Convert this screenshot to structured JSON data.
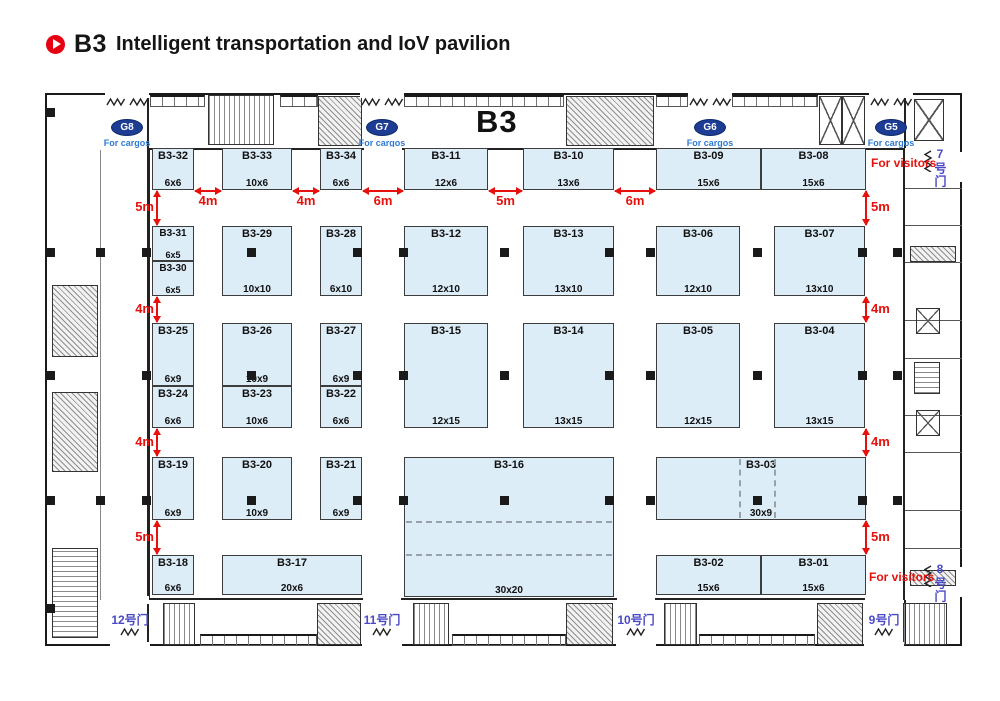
{
  "header": {
    "title_code": "B3",
    "title_text": "Intelligent transportation and IoV pavilion"
  },
  "plan": {
    "hall_label": "B3",
    "gates": [
      {
        "id": "G8",
        "cargo_label": "For cargos",
        "cx": 127
      },
      {
        "id": "G7",
        "cargo_label": "For cargos",
        "cx": 382
      },
      {
        "id": "G6",
        "cargo_label": "For cargos",
        "cx": 710
      },
      {
        "id": "G5",
        "cargo_label": "For cargos",
        "cx": 891
      }
    ],
    "visitor_labels": [
      {
        "text": "For visitors",
        "x": 871,
        "y": 156
      },
      {
        "text": "For visitors",
        "x": 869,
        "y": 570
      }
    ],
    "side_doors": [
      {
        "label": "7号门",
        "x": 934,
        "y": 147
      },
      {
        "label": "8号门",
        "x": 934,
        "y": 562
      }
    ],
    "bottom_doors": [
      {
        "label": "12号门",
        "cx": 130
      },
      {
        "label": "11号门",
        "cx": 382
      },
      {
        "label": "10号门",
        "cx": 636
      },
      {
        "label": "9号门",
        "cx": 884
      }
    ],
    "booths": [
      {
        "id": "B3-32",
        "size": "6x6",
        "x": 152,
        "y": 148,
        "w": 42,
        "h": 42
      },
      {
        "id": "B3-33",
        "size": "10x6",
        "x": 222,
        "y": 148,
        "w": 70,
        "h": 42
      },
      {
        "id": "B3-34",
        "size": "6x6",
        "x": 320,
        "y": 148,
        "w": 42,
        "h": 42
      },
      {
        "id": "B3-11",
        "size": "12x6",
        "x": 404,
        "y": 148,
        "w": 84,
        "h": 42
      },
      {
        "id": "B3-10",
        "size": "13x6",
        "x": 523,
        "y": 148,
        "w": 91,
        "h": 42
      },
      {
        "id": "B3-09",
        "size": "15x6",
        "x": 656,
        "y": 148,
        "w": 105,
        "h": 42
      },
      {
        "id": "B3-08",
        "size": "15x6",
        "x": 761,
        "y": 148,
        "w": 105,
        "h": 42
      },
      {
        "id": "B3-31",
        "size": "6x5",
        "x": 152,
        "y": 226,
        "w": 42,
        "h": 35
      },
      {
        "id": "B3-30",
        "size": "6x5",
        "x": 152,
        "y": 261,
        "w": 42,
        "h": 35
      },
      {
        "id": "B3-29",
        "size": "10x10",
        "x": 222,
        "y": 226,
        "w": 70,
        "h": 70
      },
      {
        "id": "B3-28",
        "size": "6x10",
        "x": 320,
        "y": 226,
        "w": 42,
        "h": 70
      },
      {
        "id": "B3-12",
        "size": "12x10",
        "x": 404,
        "y": 226,
        "w": 84,
        "h": 70
      },
      {
        "id": "B3-13",
        "size": "13x10",
        "x": 523,
        "y": 226,
        "w": 91,
        "h": 70
      },
      {
        "id": "B3-06",
        "size": "12x10",
        "x": 656,
        "y": 226,
        "w": 84,
        "h": 70
      },
      {
        "id": "B3-07",
        "size": "13x10",
        "x": 774,
        "y": 226,
        "w": 91,
        "h": 70
      },
      {
        "id": "B3-25",
        "size": "6x9",
        "x": 152,
        "y": 323,
        "w": 42,
        "h": 63
      },
      {
        "id": "B3-24",
        "size": "6x6",
        "x": 152,
        "y": 386,
        "w": 42,
        "h": 42
      },
      {
        "id": "B3-26",
        "size": "10x9",
        "x": 222,
        "y": 323,
        "w": 70,
        "h": 63
      },
      {
        "id": "B3-23",
        "size": "10x6",
        "x": 222,
        "y": 386,
        "w": 70,
        "h": 42
      },
      {
        "id": "B3-27",
        "size": "6x9",
        "x": 320,
        "y": 323,
        "w": 42,
        "h": 63
      },
      {
        "id": "B3-22",
        "size": "6x6",
        "x": 320,
        "y": 386,
        "w": 42,
        "h": 42
      },
      {
        "id": "B3-15",
        "size": "12x15",
        "x": 404,
        "y": 323,
        "w": 84,
        "h": 105
      },
      {
        "id": "B3-14",
        "size": "13x15",
        "x": 523,
        "y": 323,
        "w": 91,
        "h": 105
      },
      {
        "id": "B3-05",
        "size": "12x15",
        "x": 656,
        "y": 323,
        "w": 84,
        "h": 105
      },
      {
        "id": "B3-04",
        "size": "13x15",
        "x": 774,
        "y": 323,
        "w": 91,
        "h": 105
      },
      {
        "id": "B3-19",
        "size": "6x9",
        "x": 152,
        "y": 457,
        "w": 42,
        "h": 63
      },
      {
        "id": "B3-20",
        "size": "10x9",
        "x": 222,
        "y": 457,
        "w": 70,
        "h": 63
      },
      {
        "id": "B3-21",
        "size": "6x9",
        "x": 320,
        "y": 457,
        "w": 42,
        "h": 63
      },
      {
        "id": "B3-16",
        "size": "30x20",
        "x": 404,
        "y": 457,
        "w": 210,
        "h": 140,
        "dash_h": [
          63,
          96
        ]
      },
      {
        "id": "B3-03",
        "size": "30x9",
        "x": 656,
        "y": 457,
        "w": 210,
        "h": 63,
        "dash_v": [
          82,
          117
        ]
      },
      {
        "id": "B3-18",
        "size": "6x6",
        "x": 152,
        "y": 555,
        "w": 42,
        "h": 40
      },
      {
        "id": "B3-17",
        "size": "20x6",
        "x": 222,
        "y": 555,
        "w": 140,
        "h": 40
      },
      {
        "id": "B3-02",
        "size": "15x6",
        "x": 656,
        "y": 555,
        "w": 105,
        "h": 40
      },
      {
        "id": "B3-01",
        "size": "15x6",
        "x": 761,
        "y": 555,
        "w": 105,
        "h": 40
      }
    ],
    "dims": {
      "top": [
        {
          "label": "4m",
          "x1": 195,
          "x2": 221
        },
        {
          "label": "4m",
          "x1": 293,
          "x2": 319
        },
        {
          "label": "6m",
          "x1": 363,
          "x2": 403
        },
        {
          "label": "5m",
          "x1": 489,
          "x2": 522
        },
        {
          "label": "6m",
          "x1": 615,
          "x2": 655
        }
      ],
      "side": [
        {
          "label": "5m",
          "y1": 191,
          "y2": 225
        },
        {
          "label": "4m",
          "y1": 297,
          "y2": 322
        },
        {
          "label": "4m",
          "y1": 429,
          "y2": 456
        },
        {
          "label": "5m",
          "y1": 521,
          "y2": 554
        }
      ]
    },
    "pillars": {
      "xs": [
        146,
        251,
        357,
        403,
        504,
        609,
        650,
        757,
        862
      ],
      "ys": [
        252,
        375,
        500
      ],
      "extra": [
        [
          50,
          112
        ],
        [
          50,
          252
        ],
        [
          50,
          375
        ],
        [
          50,
          500
        ],
        [
          50,
          608
        ],
        [
          100,
          252
        ],
        [
          100,
          500
        ],
        [
          897,
          252
        ],
        [
          897,
          375
        ],
        [
          897,
          500
        ]
      ]
    },
    "colors": {
      "bfill": "#ddedf8",
      "bline": "#3d3d3d",
      "red": "#e8100c",
      "gblue": "#1d3c94",
      "cblue": "#2e7ad0",
      "dblue": "#4a49c5",
      "wall": "#1a1a1a"
    }
  }
}
